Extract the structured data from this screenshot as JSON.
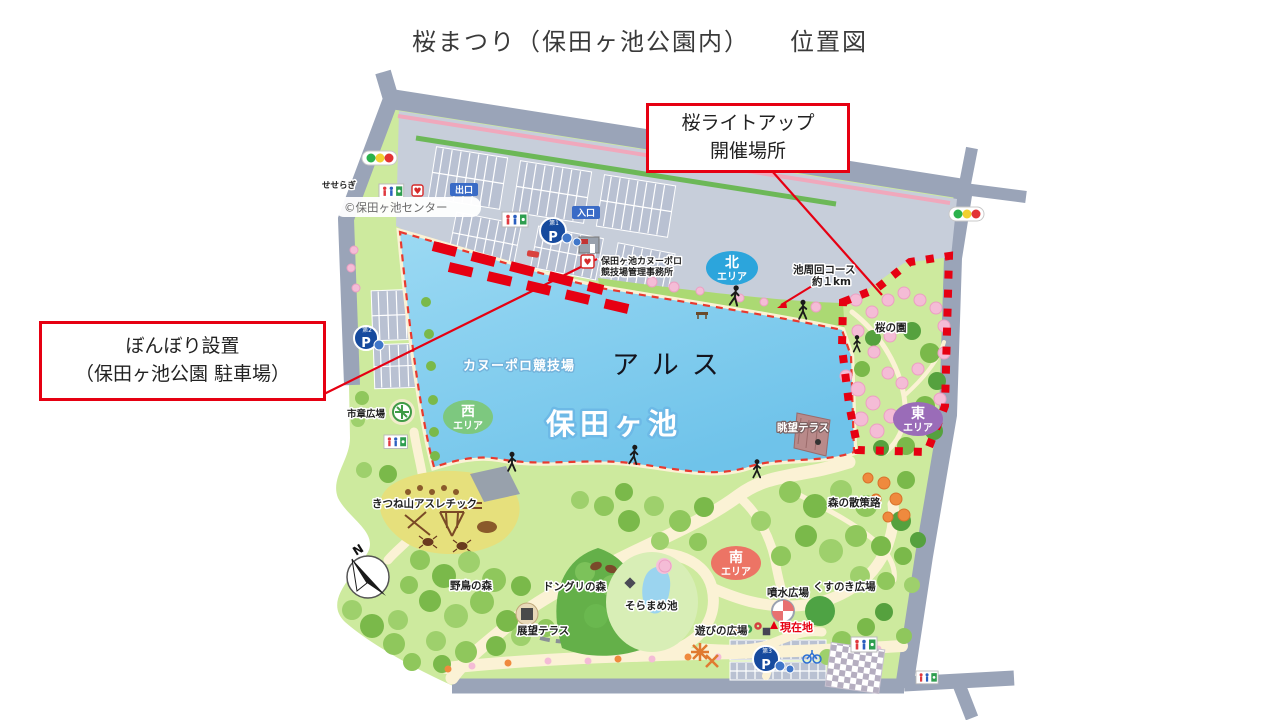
{
  "title": "桜まつり（保田ヶ池公園内）　　位置図",
  "callouts": {
    "lightup": {
      "line1": "桜ライトアップ",
      "line2": "開催場所"
    },
    "bonbori": {
      "line1": "ぼんぼり設置",
      "line2": "（保田ヶ池公園 駐車場）"
    }
  },
  "map": {
    "credit": "©保田ヶ池センター",
    "lake_name": "保田ヶ池",
    "facility_name": "アルス",
    "canoe_polo_field": "カヌーポロ競技場",
    "office": {
      "line1": "保田ヶ池カヌーポロ",
      "line2": "競技場管理事務所"
    },
    "loop_course": {
      "line1": "池周回コース",
      "line2": "約１km"
    },
    "areas": {
      "north": {
        "char": "北",
        "suffix": "エリア",
        "color": "#2ca5dc"
      },
      "west": {
        "char": "西",
        "suffix": "エリア",
        "color": "#7dc87f"
      },
      "east": {
        "char": "東",
        "suffix": "エリア",
        "color": "#9a6cb8"
      },
      "south": {
        "char": "南",
        "suffix": "エリア",
        "color": "#ec7465"
      }
    },
    "labels": {
      "seseragi": "せせらぎ",
      "exit": "出口",
      "entrance": "入口",
      "sakura_garden": "桜の園",
      "view_terrace": "眺望テラス",
      "forest_walk": "森の散策路",
      "kitsuneyama_athletic": "きつね山アスレチック",
      "city_emblem_plaza": "市章広場",
      "wild_bird_forest": "野鳥の森",
      "acorn_forest": "ドングリの森",
      "soramame_pond": "そらまめ池",
      "observation_terrace": "展望テラス",
      "play_plaza": "遊びの広場",
      "fountain_plaza": "噴水広場",
      "kusunoki_plaza": "くすのき広場",
      "current_location": "現在地"
    },
    "parking": {
      "letter": "P",
      "lots": [
        "第1",
        "第2",
        "第3"
      ]
    },
    "compass_n": "N"
  },
  "colors": {
    "accent_red": "#e60012",
    "lake_blue": "#7cc9ed",
    "park_green": "#cdea9e",
    "road_gray": "#9aa4b8",
    "sign_blue": "#3a6bc6"
  }
}
